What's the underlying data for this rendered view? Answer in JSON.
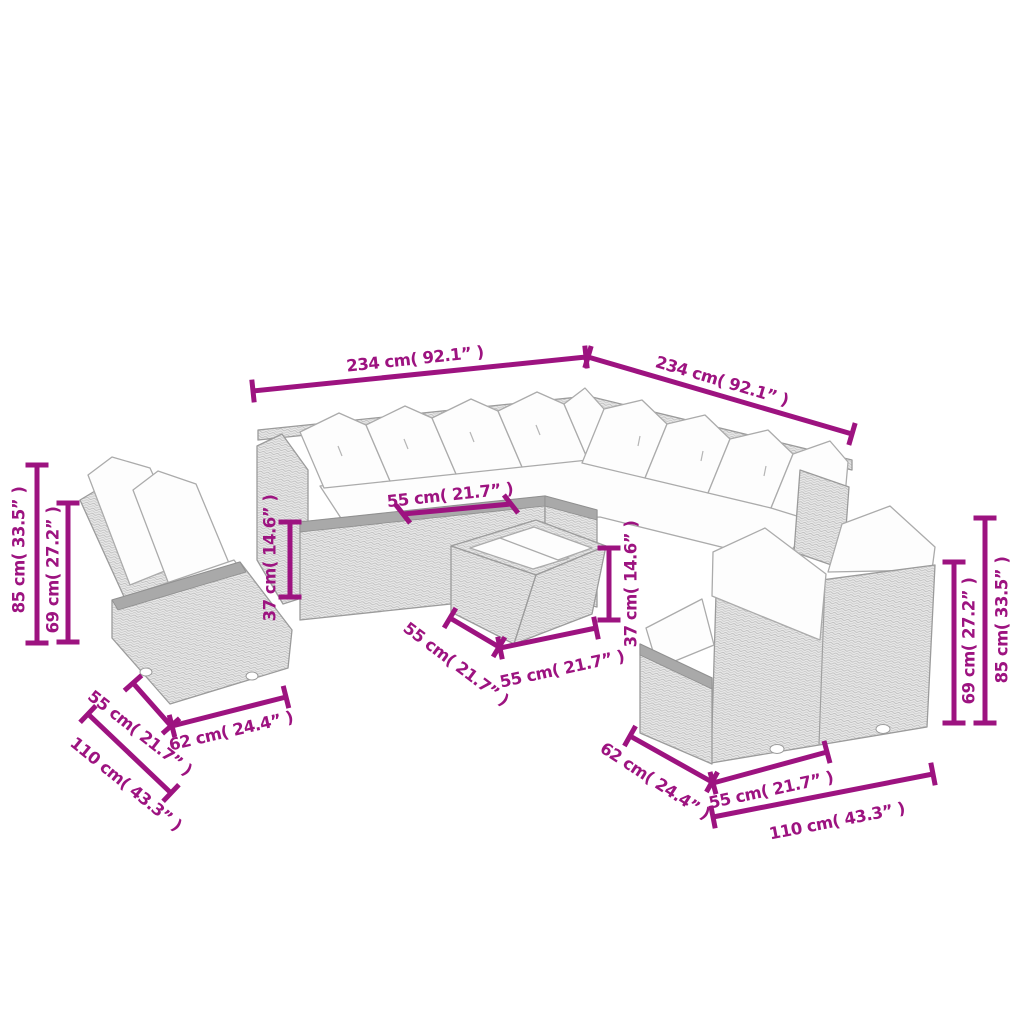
{
  "diagram": {
    "background": "#ffffff",
    "dimension_color": "#9D1380",
    "furniture_outline_color": "#9b9b9b",
    "wicker_fill": "#e9e9e9",
    "cushion_fill": "#fdfdfd",
    "unit_primary": "cm",
    "unit_secondary": "inch"
  },
  "dims": {
    "width_left": "234 cm( 92.1” )",
    "width_right": "234 cm( 92.1” )",
    "height_left_total": "85 cm( 33.5” )",
    "height_left_back": "69 cm( 27.2” )",
    "seat_height_left": "37 cm( 14.6” )",
    "seat_width_top": "55 cm( 21.7” )",
    "table_height": "37 cm( 14.6” )",
    "table_depth": "55 cm( 21.7” )",
    "table_width": "55 cm( 21.7” )",
    "left_unit_depth_55": "55 cm( 21.7” )",
    "left_unit_width_62": "62 cm( 24.4” )",
    "left_unit_width_110": "110 cm( 43.3” )",
    "right_unit_depth_62": "62 cm( 24.4” )",
    "right_unit_width_55": "55 cm( 21.7” )",
    "right_unit_width_110": "110 cm( 43.3” )",
    "height_right_back": "69 cm( 27.2” )",
    "height_right_total": "85 cm( 33.5” )"
  }
}
